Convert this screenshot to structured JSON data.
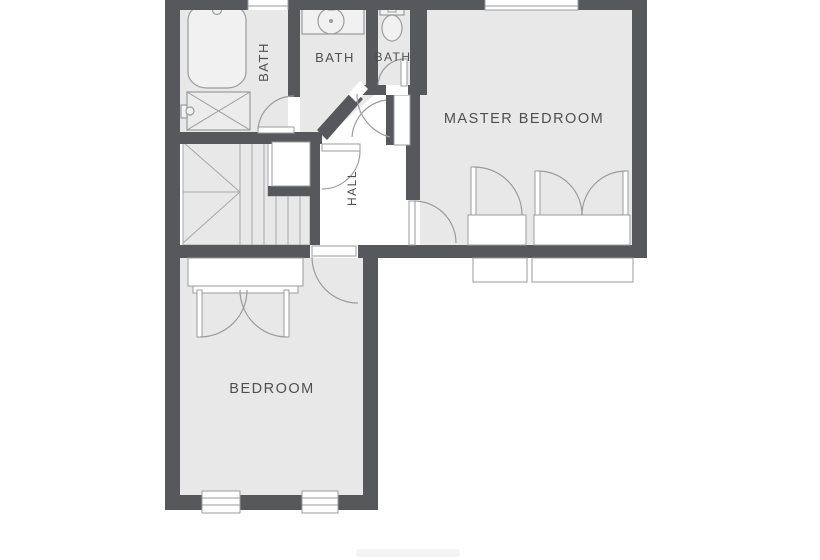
{
  "plan": {
    "rooms": {
      "bath_left": {
        "label": "BATH"
      },
      "bath_middle": {
        "label": "BATH"
      },
      "bath_small": {
        "label": "BATH"
      },
      "master_bedroom": {
        "label": "MASTER BEDROOM"
      },
      "hall": {
        "label": "HALL"
      },
      "bedroom": {
        "label": "BEDROOM"
      }
    },
    "fixtures": [
      "bathtub-icon",
      "shower-icon",
      "shower-tap-icon",
      "sink-icon",
      "toilet-icon",
      "staircase-icon"
    ],
    "colors": {
      "wall": "#57585b",
      "room_fill": "#e8e8e9",
      "fixture_fill": "#f1f1f2",
      "outline": "#9a9b9d",
      "label_text": "#4e4f51",
      "background": "#ffffff"
    }
  }
}
